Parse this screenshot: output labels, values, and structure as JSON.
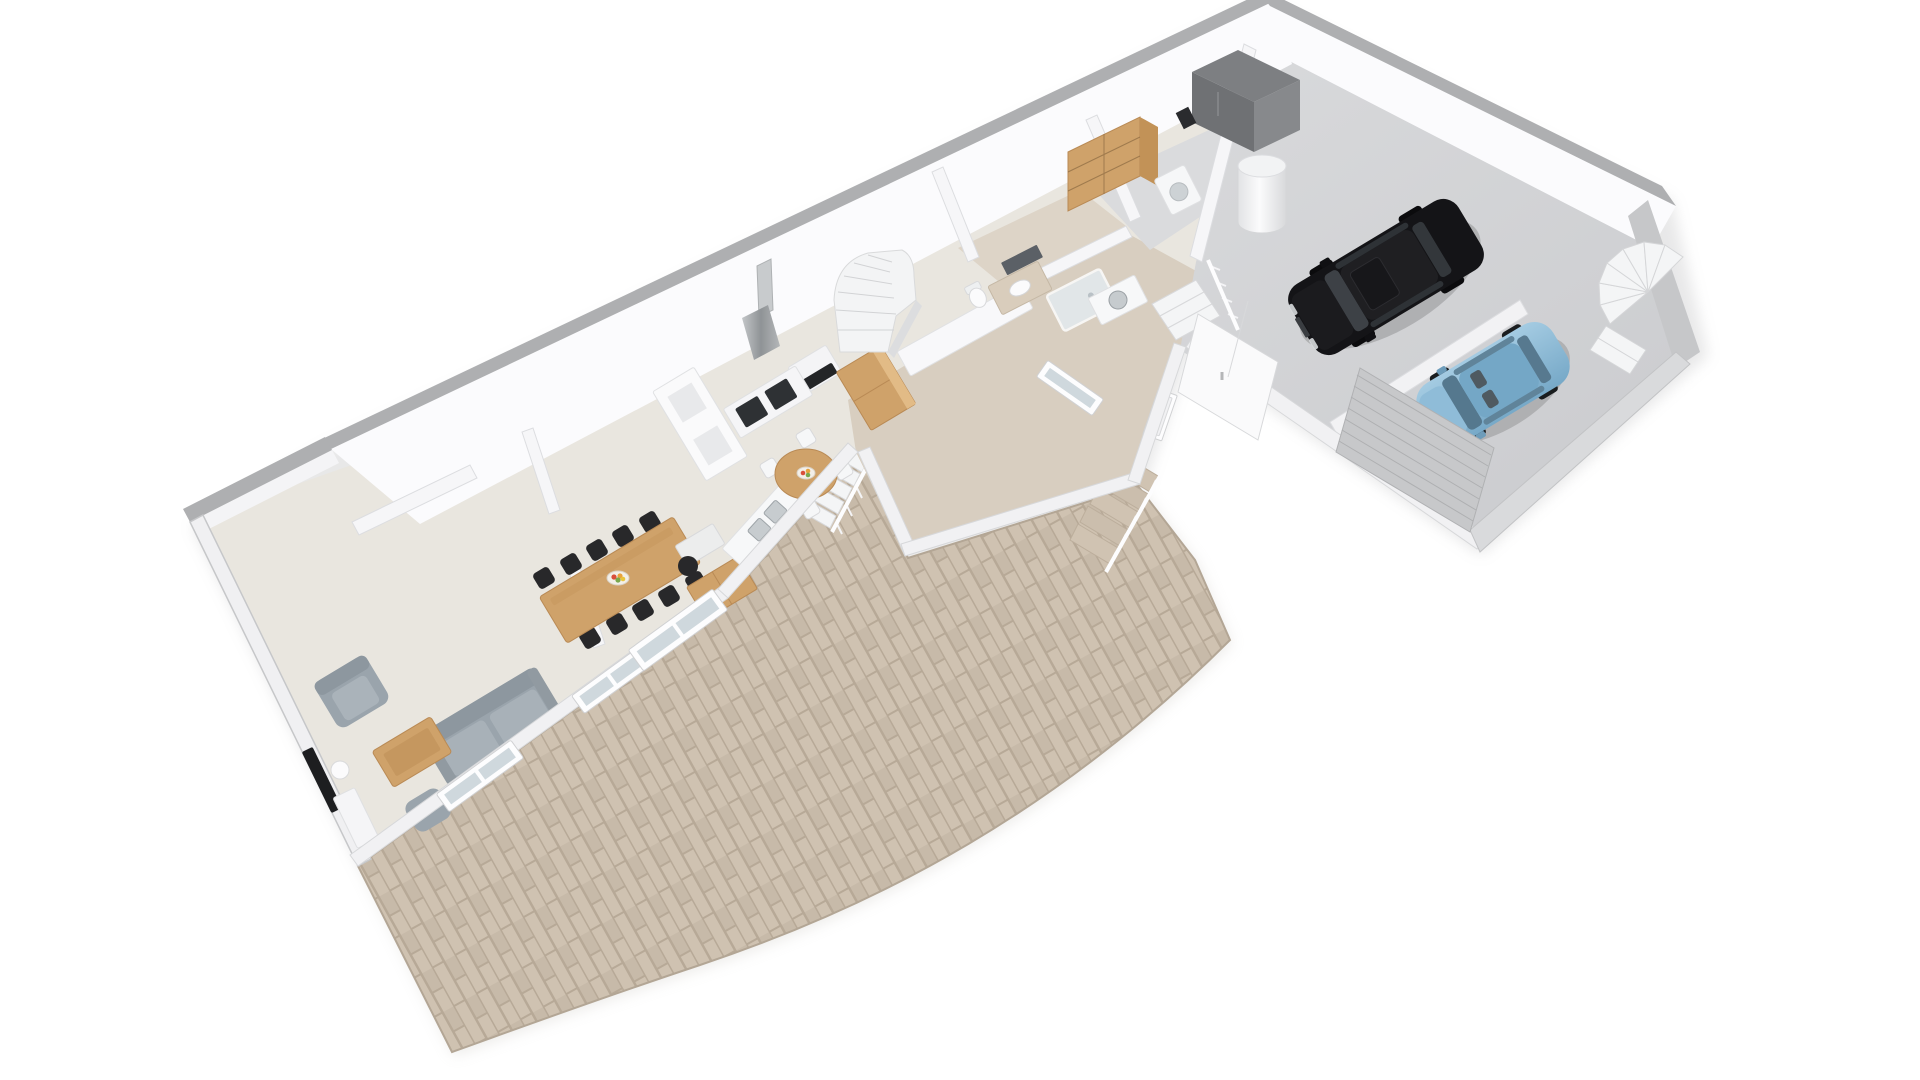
{
  "scene": {
    "type": "3d-floor-plan-render",
    "view": "isometric-top-down",
    "background": "#ffffff",
    "level": "ground-floor-with-garage-and-terrace"
  },
  "palette": {
    "background": "#ffffff",
    "wall_cap": "#aeafb1",
    "wall_face": "#fbfbfd",
    "garage_wall": "#c6c7c9",
    "floor_main": "#e9e6df",
    "floor_hall": "#d8cec0",
    "floor_bath": "#ddd4c7",
    "floor_utility": "#dadbdd",
    "floor_garage": "#d3d5d7",
    "terrace_grout": "#b7a997",
    "terrace_tile": "#cfc2b1",
    "terrace_tile_alt": "#c7baa9",
    "wood": "#cfa26a",
    "wood_dark": "#b98a55",
    "sofa_gray": "#9aa4ac",
    "chair_black": "#28282a",
    "chair_white": "#f6f7f8",
    "suv_black": "#141417",
    "hatchback_blue": "#8fbcd8",
    "glass": "#cfd8dd",
    "stair_white": "#f3f4f5",
    "metal": "#9aa0a4"
  },
  "rooms": [
    {
      "id": "living-room",
      "label": "Living room",
      "floor_color": "#e9e6df",
      "furniture": [
        "sofa",
        "armchair",
        "pouf",
        "coffee-table",
        "tv",
        "floor-lamp",
        "media-unit",
        "wall-ledge"
      ]
    },
    {
      "id": "dining-room",
      "label": "Dining room",
      "floor_color": "#e9e6df",
      "furniture": [
        "long-dining-table",
        "black-chairs-x10",
        "fruit-bowl",
        "desk",
        "office-chair",
        "wood-sideboard"
      ]
    },
    {
      "id": "kitchen",
      "label": "Kitchen",
      "floor_color": "#e9e6df",
      "furniture": [
        "round-table",
        "white-chairs-x4",
        "fruit-bowl",
        "cooktop-counter",
        "oven",
        "extractor-chimney",
        "tall-pantry-cabinet",
        "sink-counter",
        "peninsula-counter",
        "shelf-niche"
      ]
    },
    {
      "id": "entry-hall",
      "label": "Entry hall / corridor",
      "floor_color": "#d8cec0",
      "furniture": [
        "winder-staircase",
        "front-door"
      ]
    },
    {
      "id": "bathroom",
      "label": "Bathroom",
      "floor_color": "#ddd4c7",
      "furniture": [
        "vanity-sink",
        "mirror",
        "shower",
        "toilet"
      ]
    },
    {
      "id": "utility-room",
      "label": "Utility room",
      "floor_color": "#dadbdd",
      "furniture": [
        "wood-bookshelf",
        "washing-machine",
        "water-heater",
        "laundry-sink"
      ]
    },
    {
      "id": "garage",
      "label": "Garage",
      "floor_color": "#d3d5d7",
      "furniture": [
        "storage-cabinet",
        "wall-panel",
        "partition-wall",
        "interior-railing-steps",
        "spiral-staircase",
        "double-entry-door",
        "sectional-garage-door"
      ]
    },
    {
      "id": "terrace",
      "label": "Terrace",
      "floor_color": "#cfc2b1",
      "furniture": [
        "tiled-paving",
        "exterior-staircase",
        "balustrade",
        "driveway-step-ramp"
      ]
    }
  ],
  "vehicles": [
    {
      "id": "suv",
      "label": "black-suv",
      "color": "#141417"
    },
    {
      "id": "hatchback",
      "label": "blue-hatchback",
      "color": "#8fbcd8"
    }
  ],
  "stairs": [
    "hall-winder-staircase",
    "garage-spiral-staircase",
    "terrace-exterior-stairs",
    "driveway-ramp-stairs"
  ]
}
